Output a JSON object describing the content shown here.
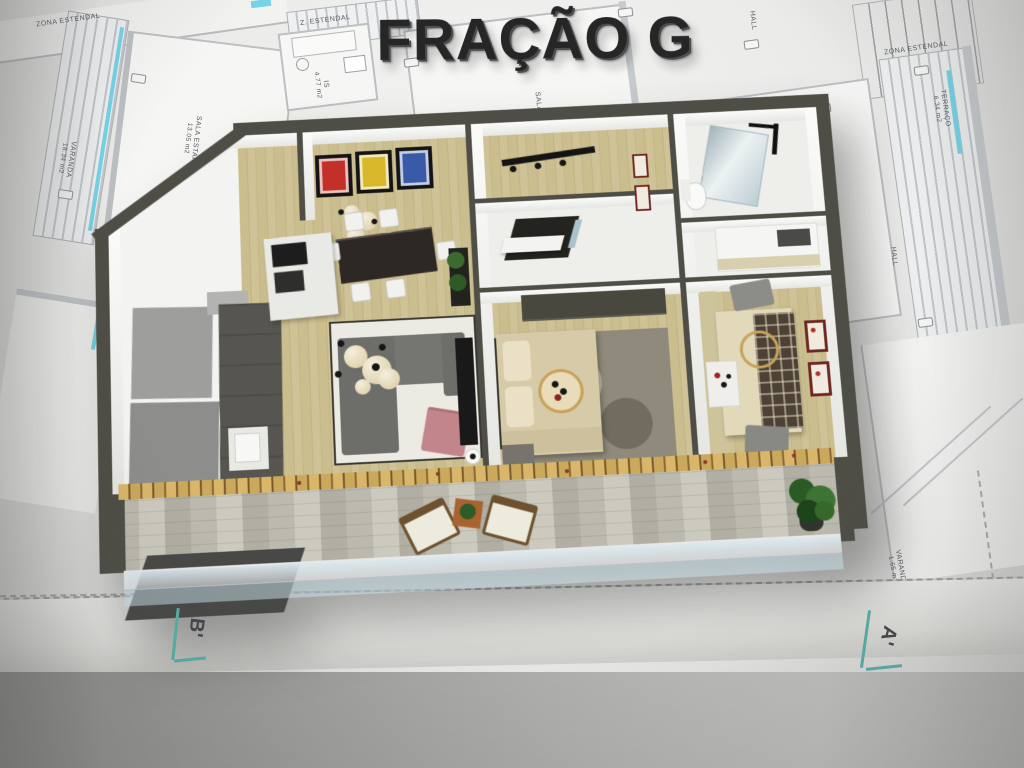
{
  "title": {
    "text": "FRAÇÃO G"
  },
  "section_markers": {
    "left": "B'",
    "right": "A'"
  },
  "blueprint": {
    "labels": {
      "zona_estendal_left": "ZONA ESTENDAL",
      "varanda_left_name": "VARANDA",
      "varanda_left_area": "18.34 m2",
      "sala_estar_name": "SALA ESTAR",
      "sala_estar_area": "13.05 m2",
      "z_estendal": "Z. ESTENDAL",
      "is_name": "IS",
      "is_area": "4.77 m2",
      "sala_condominio_name": "SALA CONDOMÍNIO",
      "sala_condominio_area": "17.55 m2",
      "hall_top": "HALL",
      "cozinha_name": "COZINHA/SALA REFEIÇÕES",
      "cozinha_area": "18.18 m2",
      "zona_estendal_right": "ZONA ESTENDAL",
      "terraco_name": "TERRAÇO",
      "terraco_area": "6.34 m2",
      "hall_right": "HALL",
      "varanda_right_name": "VARANDA",
      "varanda_right_area": "1.65 m2"
    }
  },
  "colors": {
    "outer_wall": "#4e4e46",
    "accent_teal": "#58b0aa",
    "window_cyan": "#74d4e6",
    "wood_floor": "#c7ba8c",
    "blueprint_line": "#bcc0c3",
    "title_color": "#262626"
  }
}
